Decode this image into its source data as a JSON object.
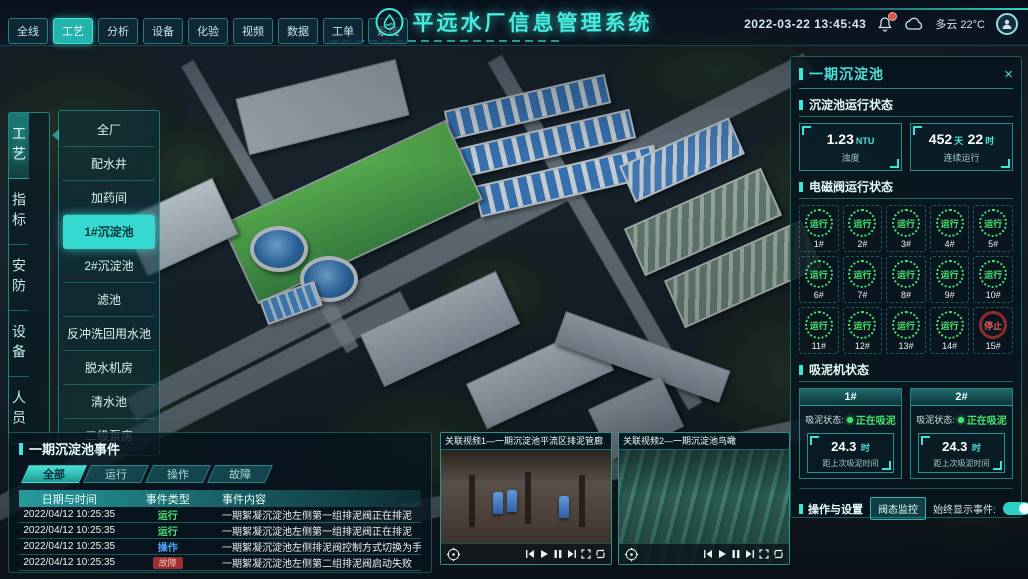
{
  "header": {
    "nav": [
      {
        "label": "全线"
      },
      {
        "label": "工艺"
      },
      {
        "label": "分析"
      },
      {
        "label": "设备"
      },
      {
        "label": "化验"
      },
      {
        "label": "视频"
      },
      {
        "label": "数据"
      },
      {
        "label": "工单"
      },
      {
        "label": "系统"
      }
    ],
    "title": "平远水厂信息管理系统",
    "datetime": "2022-03-22 13:45:43",
    "weather": "多云 22°C"
  },
  "side_tabs": [
    {
      "label": "工艺"
    },
    {
      "label": "指标"
    },
    {
      "label": "安防"
    },
    {
      "label": "设备"
    },
    {
      "label": "人员"
    }
  ],
  "process_menu": [
    {
      "label": "全厂"
    },
    {
      "label": "配水井"
    },
    {
      "label": "加药间"
    },
    {
      "label": "1#沉淀池"
    },
    {
      "label": "2#沉淀池"
    },
    {
      "label": "滤池"
    },
    {
      "label": "反冲洗回用水池"
    },
    {
      "label": "脱水机房"
    },
    {
      "label": "清水池"
    },
    {
      "label": "二级泵房"
    }
  ],
  "right_panel": {
    "title": "一期沉淀池",
    "close_label": "×",
    "run_status": {
      "title": "沉淀池运行状态",
      "turbidity": {
        "value": "1.23",
        "unit": "NTU",
        "label": "浊度"
      },
      "uptime": {
        "value_a": "452",
        "unit_a": "天",
        "value_b": "22",
        "unit_b": "时",
        "label": "连续运行"
      }
    },
    "valves": {
      "title": "电磁阀运行状态",
      "items": [
        {
          "id": "1#",
          "status": "运行"
        },
        {
          "id": "2#",
          "status": "运行"
        },
        {
          "id": "3#",
          "status": "运行"
        },
        {
          "id": "4#",
          "status": "运行"
        },
        {
          "id": "5#",
          "status": "运行"
        },
        {
          "id": "6#",
          "status": "运行"
        },
        {
          "id": "7#",
          "status": "运行"
        },
        {
          "id": "8#",
          "status": "运行"
        },
        {
          "id": "9#",
          "status": "运行"
        },
        {
          "id": "10#",
          "status": "运行"
        },
        {
          "id": "11#",
          "status": "运行"
        },
        {
          "id": "12#",
          "status": "运行"
        },
        {
          "id": "13#",
          "status": "运行"
        },
        {
          "id": "14#",
          "status": "运行"
        },
        {
          "id": "15#",
          "status": "停止"
        }
      ]
    },
    "mud_machines": {
      "title": "吸泥机状态",
      "status_label": "吸泥状态:",
      "items": [
        {
          "id": "1#",
          "status": "正在吸泥",
          "value": "24.3",
          "unit": "时",
          "label": "距上次吸泥时间"
        },
        {
          "id": "2#",
          "status": "正在吸泥",
          "value": "24.3",
          "unit": "时",
          "label": "距上次吸泥时间"
        }
      ]
    },
    "operations": {
      "title": "操作与设置",
      "monitor_button": "阀态监控",
      "toggle_label": "始终显示事件:"
    }
  },
  "events_panel": {
    "title": "一期沉淀池事件",
    "tabs": [
      {
        "label": "全部"
      },
      {
        "label": "运行"
      },
      {
        "label": "操作"
      },
      {
        "label": "故障"
      }
    ],
    "columns": [
      "日期与时间",
      "事件类型",
      "事件内容"
    ],
    "rows": [
      {
        "time": "2022/04/12 10:25:35",
        "type": "运行",
        "content": "一期絮凝沉淀池左侧第一组排泥阀正在排泥"
      },
      {
        "time": "2022/04/12 10:25:35",
        "type": "运行",
        "content": "一期絮凝沉淀池左侧第一组排泥阀正在排泥"
      },
      {
        "time": "2022/04/12 10:25:35",
        "type": "操作",
        "content": "一期絮凝沉淀池左侧排泥阀控制方式切换为手动"
      },
      {
        "time": "2022/04/12 10:25:35",
        "type": "故障",
        "content": "一期絮凝沉淀池左侧第二组排泥阀启动失败"
      }
    ]
  },
  "videos": [
    {
      "title": "关联视频1—一期沉淀池平流区排泥管廊"
    },
    {
      "title": "关联视频2—一期沉淀池鸟瞰"
    }
  ],
  "colors": {
    "accent": "#3ee6d8",
    "run_green": "#46e26f",
    "stop_red": "#e05b5b",
    "op_blue": "#4da6ff"
  }
}
